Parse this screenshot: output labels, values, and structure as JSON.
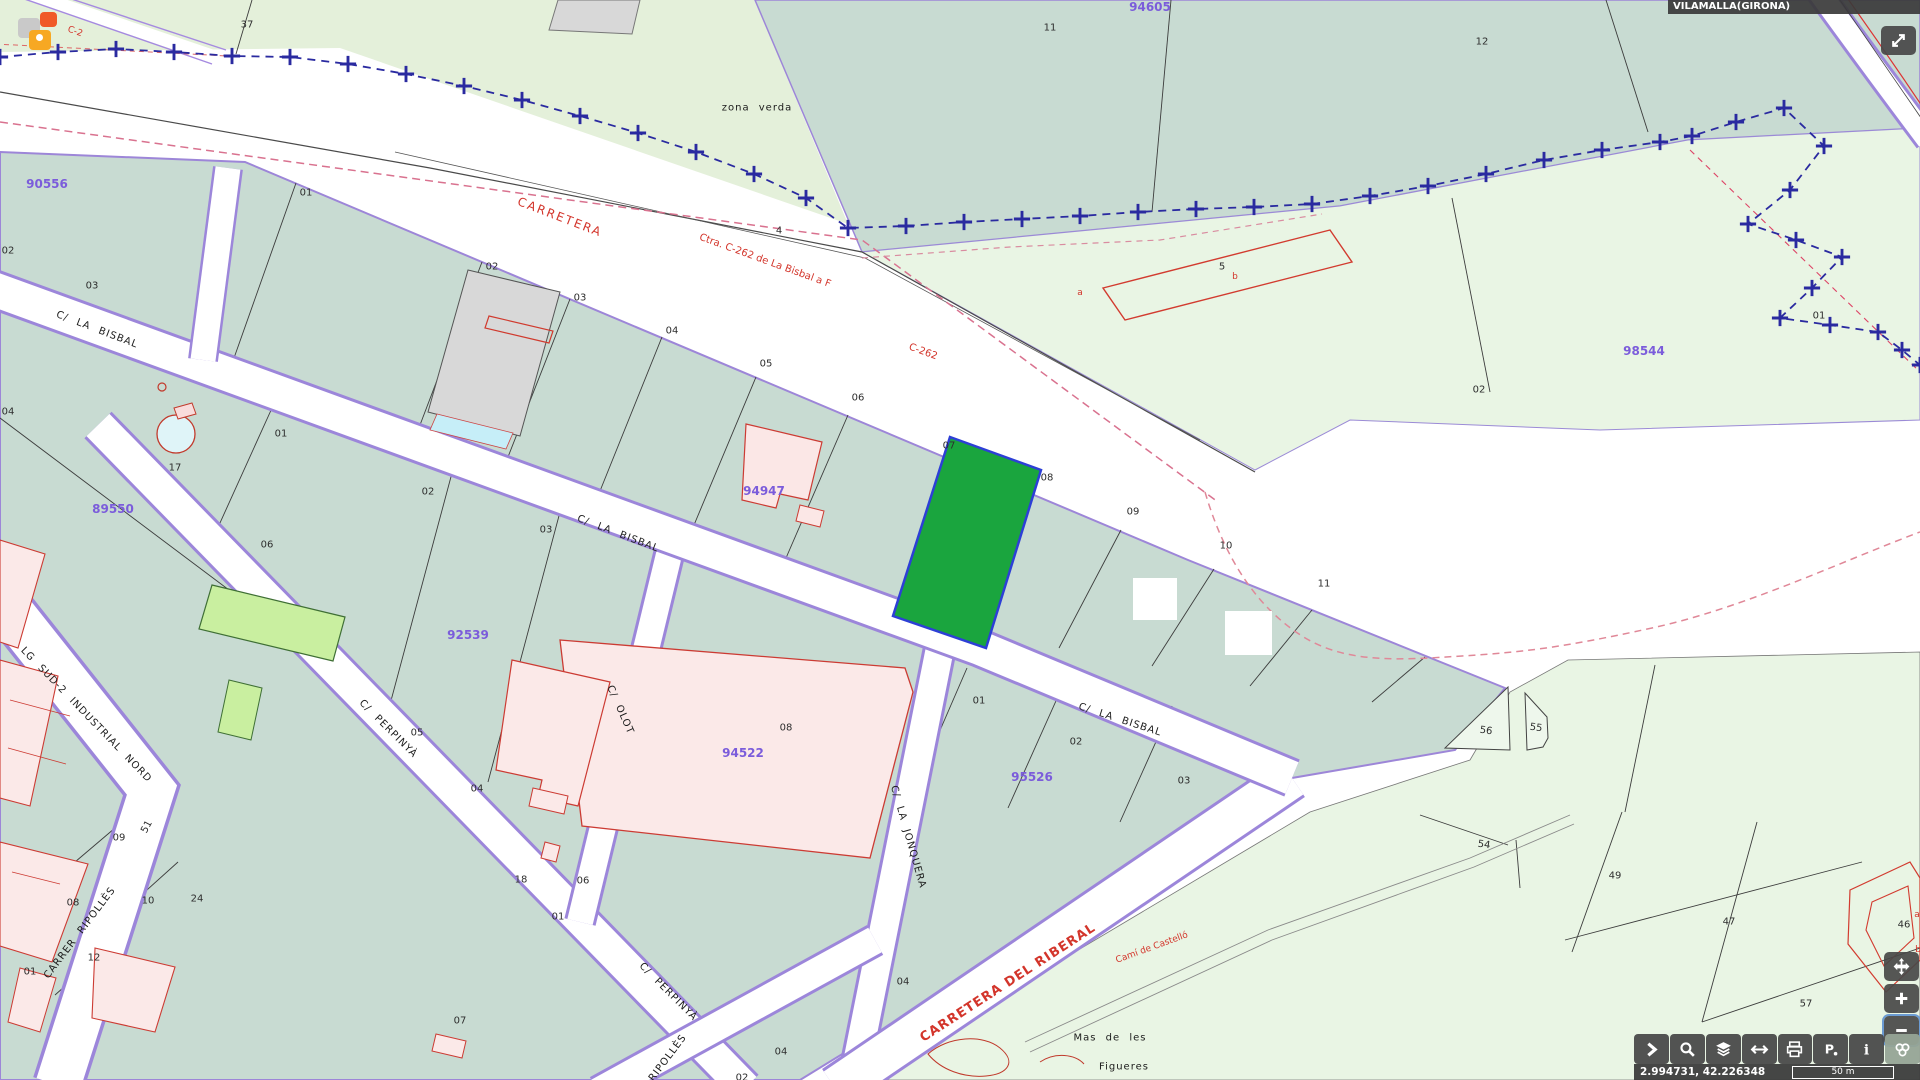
{
  "header": {
    "municipality": "VILAMALLA(GIRONA)"
  },
  "statusbar": {
    "coordinates": "2.994731, 42.226348",
    "scale": "50 m"
  },
  "toolbar": {
    "buttons": [
      {
        "id": "expand-panel",
        "icon": "chevron"
      },
      {
        "id": "search",
        "icon": "magnifier"
      },
      {
        "id": "layers",
        "icon": "layers"
      },
      {
        "id": "measure",
        "icon": "harrows"
      },
      {
        "id": "print",
        "icon": "printer"
      },
      {
        "id": "street-view",
        "icon": "ppin"
      },
      {
        "id": "info",
        "icon": "info"
      },
      {
        "id": "base-maps",
        "icon": "circles",
        "active": true
      }
    ]
  },
  "controls": [
    {
      "id": "fullscreen",
      "icon": "expand"
    },
    {
      "id": "pan",
      "icon": "pan"
    },
    {
      "id": "zoom-in",
      "icon": "plus"
    },
    {
      "id": "zoom-out",
      "icon": "minus"
    }
  ],
  "markers": {
    "colors": [
      "#c9c9c9",
      "#f05a28",
      "#f7a823"
    ]
  },
  "colors": {
    "selected_parcel": "#1aa53e",
    "selected_border": "#2d3fd6",
    "urban_parcel": "#c8dbd2",
    "rustic_parcel": "#e9f5e4",
    "road_casing": "#9c86da",
    "reference": "#7b5cdb",
    "boundary": "#2a2aa0",
    "road_text": "#d3352b"
  },
  "map_labels": [
    {
      "t": "90556",
      "x": 47,
      "y": 184,
      "r": 0,
      "c": "ref"
    },
    {
      "t": "89550",
      "x": 113,
      "y": 509,
      "r": 0,
      "c": "ref"
    },
    {
      "t": "92539",
      "x": 468,
      "y": 635,
      "r": 0,
      "c": "ref"
    },
    {
      "t": "94522",
      "x": 743,
      "y": 753,
      "r": 0,
      "c": "ref"
    },
    {
      "t": "94947",
      "x": 764,
      "y": 491,
      "r": 0,
      "c": "ref"
    },
    {
      "t": "95526",
      "x": 1032,
      "y": 777,
      "r": 0,
      "c": "ref"
    },
    {
      "t": "94605",
      "x": 1150,
      "y": 7,
      "r": 0,
      "c": "ref"
    },
    {
      "t": "98544",
      "x": 1644,
      "y": 351,
      "r": 0,
      "c": "ref"
    },
    {
      "t": "37",
      "x": 247,
      "y": 25,
      "r": 0,
      "c": "plot"
    },
    {
      "t": "11",
      "x": 1050,
      "y": 28,
      "r": 0,
      "c": "plot"
    },
    {
      "t": "12",
      "x": 1482,
      "y": 42,
      "r": 0,
      "c": "plot"
    },
    {
      "t": "4",
      "x": 779,
      "y": 231,
      "r": 0,
      "c": "plot"
    },
    {
      "t": "5",
      "x": 1222,
      "y": 267,
      "r": 0,
      "c": "plot"
    },
    {
      "t": "02",
      "x": 8,
      "y": 251,
      "r": 0,
      "c": "plot"
    },
    {
      "t": "03",
      "x": 92,
      "y": 286,
      "r": 0,
      "c": "plot"
    },
    {
      "t": "01",
      "x": 306,
      "y": 193,
      "r": 0,
      "c": "plot"
    },
    {
      "t": "02",
      "x": 492,
      "y": 267,
      "r": 0,
      "c": "plot"
    },
    {
      "t": "03",
      "x": 580,
      "y": 298,
      "r": 0,
      "c": "plot"
    },
    {
      "t": "04",
      "x": 672,
      "y": 331,
      "r": 0,
      "c": "plot"
    },
    {
      "t": "05",
      "x": 766,
      "y": 364,
      "r": 0,
      "c": "plot"
    },
    {
      "t": "06",
      "x": 858,
      "y": 398,
      "r": 0,
      "c": "plot"
    },
    {
      "t": "07",
      "x": 949,
      "y": 446,
      "r": 0,
      "c": "plot"
    },
    {
      "t": "08",
      "x": 1047,
      "y": 478,
      "r": 0,
      "c": "plot"
    },
    {
      "t": "09",
      "x": 1133,
      "y": 512,
      "r": 0,
      "c": "plot"
    },
    {
      "t": "10",
      "x": 1226,
      "y": 546,
      "r": 0,
      "c": "plot"
    },
    {
      "t": "11",
      "x": 1324,
      "y": 584,
      "r": 0,
      "c": "plot"
    },
    {
      "t": "01",
      "x": 281,
      "y": 434,
      "r": 0,
      "c": "plot"
    },
    {
      "t": "02",
      "x": 428,
      "y": 492,
      "r": 0,
      "c": "plot"
    },
    {
      "t": "03",
      "x": 546,
      "y": 530,
      "r": 0,
      "c": "plot"
    },
    {
      "t": "06",
      "x": 267,
      "y": 545,
      "r": 0,
      "c": "plot"
    },
    {
      "t": "17",
      "x": 175,
      "y": 468,
      "r": 0,
      "c": "plot"
    },
    {
      "t": "04",
      "x": 8,
      "y": 412,
      "r": 0,
      "c": "plot"
    },
    {
      "t": "05",
      "x": 417,
      "y": 733,
      "r": 0,
      "c": "plot"
    },
    {
      "t": "04",
      "x": 477,
      "y": 789,
      "r": 0,
      "c": "plot"
    },
    {
      "t": "08",
      "x": 786,
      "y": 728,
      "r": 0,
      "c": "plot"
    },
    {
      "t": "01",
      "x": 979,
      "y": 701,
      "r": 0,
      "c": "plot"
    },
    {
      "t": "02",
      "x": 1076,
      "y": 742,
      "r": 0,
      "c": "plot"
    },
    {
      "t": "03",
      "x": 1184,
      "y": 781,
      "r": 0,
      "c": "plot"
    },
    {
      "t": "09",
      "x": 119,
      "y": 838,
      "r": 0,
      "c": "plot"
    },
    {
      "t": "08",
      "x": 73,
      "y": 903,
      "r": 0,
      "c": "plot"
    },
    {
      "t": "10",
      "x": 148,
      "y": 901,
      "r": 0,
      "c": "plot"
    },
    {
      "t": "24",
      "x": 197,
      "y": 899,
      "r": 0,
      "c": "plot"
    },
    {
      "t": "12",
      "x": 94,
      "y": 958,
      "r": 0,
      "c": "plot"
    },
    {
      "t": "01",
      "x": 30,
      "y": 972,
      "r": 0,
      "c": "plot"
    },
    {
      "t": "51",
      "x": 147,
      "y": 827,
      "r": -62,
      "c": "plot"
    },
    {
      "t": "18",
      "x": 521,
      "y": 880,
      "r": 0,
      "c": "plot"
    },
    {
      "t": "06",
      "x": 583,
      "y": 881,
      "r": 0,
      "c": "plot"
    },
    {
      "t": "01",
      "x": 558,
      "y": 917,
      "r": 0,
      "c": "plot"
    },
    {
      "t": "07",
      "x": 460,
      "y": 1021,
      "r": 0,
      "c": "plot"
    },
    {
      "t": "04",
      "x": 903,
      "y": 982,
      "r": 0,
      "c": "plot"
    },
    {
      "t": "04",
      "x": 781,
      "y": 1052,
      "r": 0,
      "c": "plot"
    },
    {
      "t": "02",
      "x": 742,
      "y": 1078,
      "r": 0,
      "c": "plot"
    },
    {
      "t": "02",
      "x": 1479,
      "y": 390,
      "r": 0,
      "c": "plot"
    },
    {
      "t": "01",
      "x": 1819,
      "y": 316,
      "r": 0,
      "c": "plot"
    },
    {
      "t": "54",
      "x": 1484,
      "y": 845,
      "r": 8,
      "c": "plot"
    },
    {
      "t": "49",
      "x": 1615,
      "y": 876,
      "r": 0,
      "c": "plot"
    },
    {
      "t": "47",
      "x": 1729,
      "y": 922,
      "r": 0,
      "c": "plot"
    },
    {
      "t": "57",
      "x": 1806,
      "y": 1004,
      "r": 0,
      "c": "plot"
    },
    {
      "t": "56",
      "x": 1486,
      "y": 731,
      "r": 8,
      "c": "plot"
    },
    {
      "t": "55",
      "x": 1536,
      "y": 728,
      "r": 8,
      "c": "plot"
    },
    {
      "t": "46",
      "x": 1904,
      "y": 925,
      "r": 0,
      "c": "plot"
    },
    {
      "t": "b",
      "x": 1235,
      "y": 277,
      "r": 0,
      "c": "redsmall"
    },
    {
      "t": "a",
      "x": 1080,
      "y": 293,
      "r": 0,
      "c": "redsmall"
    },
    {
      "t": "a",
      "x": 1917,
      "y": 915,
      "r": 0,
      "c": "redsmall"
    },
    {
      "t": "b",
      "x": 1918,
      "y": 950,
      "r": 0,
      "c": "redsmall"
    },
    {
      "t": "C-2",
      "x": 75,
      "y": 32,
      "r": 20,
      "c": "redsmall"
    },
    {
      "t": "C/ LA BISBAL",
      "x": 97,
      "y": 330,
      "r": 21,
      "c": "street"
    },
    {
      "t": "C/ LA BISBAL",
      "x": 618,
      "y": 534,
      "r": 21,
      "c": "street"
    },
    {
      "t": "C/ LA BISBAL",
      "x": 1120,
      "y": 720,
      "r": 18,
      "c": "street"
    },
    {
      "t": "LG SUD-2 INDUSTRIAL NORD",
      "x": 86,
      "y": 715,
      "r": 46,
      "c": "street"
    },
    {
      "t": "CARRER RIPOLLÈS",
      "x": 80,
      "y": 933,
      "r": -53,
      "c": "street"
    },
    {
      "t": "RIPOLLÈS",
      "x": 668,
      "y": 1058,
      "r": -53,
      "c": "street"
    },
    {
      "t": "C/ PERPINYÀ",
      "x": 388,
      "y": 729,
      "r": 45,
      "c": "street"
    },
    {
      "t": "C/ PERPINYÀ",
      "x": 668,
      "y": 992,
      "r": 45,
      "c": "street"
    },
    {
      "t": "C/ OLOT",
      "x": 620,
      "y": 710,
      "r": 66,
      "c": "street"
    },
    {
      "t": "C/ LA JONQUERA",
      "x": 908,
      "y": 837,
      "r": 74,
      "c": "street"
    },
    {
      "t": "zona verda",
      "x": 757,
      "y": 108,
      "r": 0,
      "c": "street"
    },
    {
      "t": "Mas de les",
      "x": 1110,
      "y": 1038,
      "r": 0,
      "c": "street"
    },
    {
      "t": "Figueres",
      "x": 1124,
      "y": 1067,
      "r": 0,
      "c": "street"
    },
    {
      "t": "CARRETERA",
      "x": 560,
      "y": 217,
      "r": 21,
      "c": "red-road"
    },
    {
      "t": "Ctra. C-262 de La Bisbal a F",
      "x": 765,
      "y": 261,
      "r": 20,
      "c": "red-mid"
    },
    {
      "t": "C-262",
      "x": 923,
      "y": 352,
      "r": 20,
      "c": "red-mid"
    },
    {
      "t": "CARRETERA DEL RIBERAL",
      "x": 1008,
      "y": 983,
      "r": -33,
      "c": "red-road-big"
    },
    {
      "t": "Camí de Castelló",
      "x": 1152,
      "y": 948,
      "r": -20,
      "c": "red-sm2"
    }
  ]
}
